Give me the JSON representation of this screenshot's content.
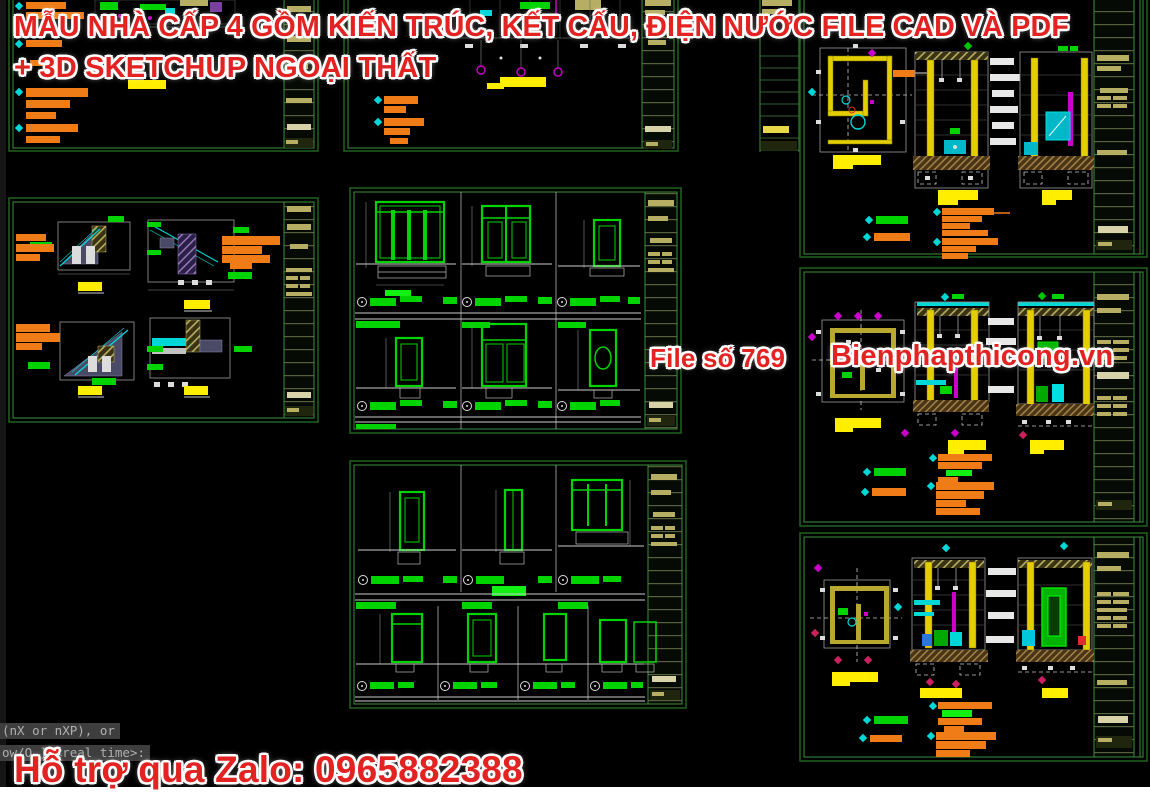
{
  "overlay": {
    "title_line1": "MẪU NHÀ CẤP 4 GỒM KIẾN TRÚC, KẾT CẤU, ĐIỆN NƯỚC FILE CAD VÀ PDF",
    "title_line2": "+ 3D SKETCHUP NGOẠI THẤT",
    "file_label": "File số 769",
    "website": "Bienphapthicong.vn",
    "support": "Hỗ trợ qua Zalo: 0965882388"
  },
  "command_line": {
    "line1": "(nX or nXP), or",
    "line2": "ow/O ] <real time>:"
  },
  "colors": {
    "background": "#000000",
    "sheet_border_green": "#3c8f3c",
    "door_green": "#00d400",
    "note_orange": "#ef7c16",
    "highlight_yellow": "#ffee00",
    "annotation_cyan": "#00d8d8",
    "grid_magenta": "#cc00cc",
    "titleblock_khaki": "#b6ae62",
    "overlay_red": "#e32222",
    "command_text_gray": "#b0b0b0",
    "bottom_strip_white": "#ffffff"
  }
}
